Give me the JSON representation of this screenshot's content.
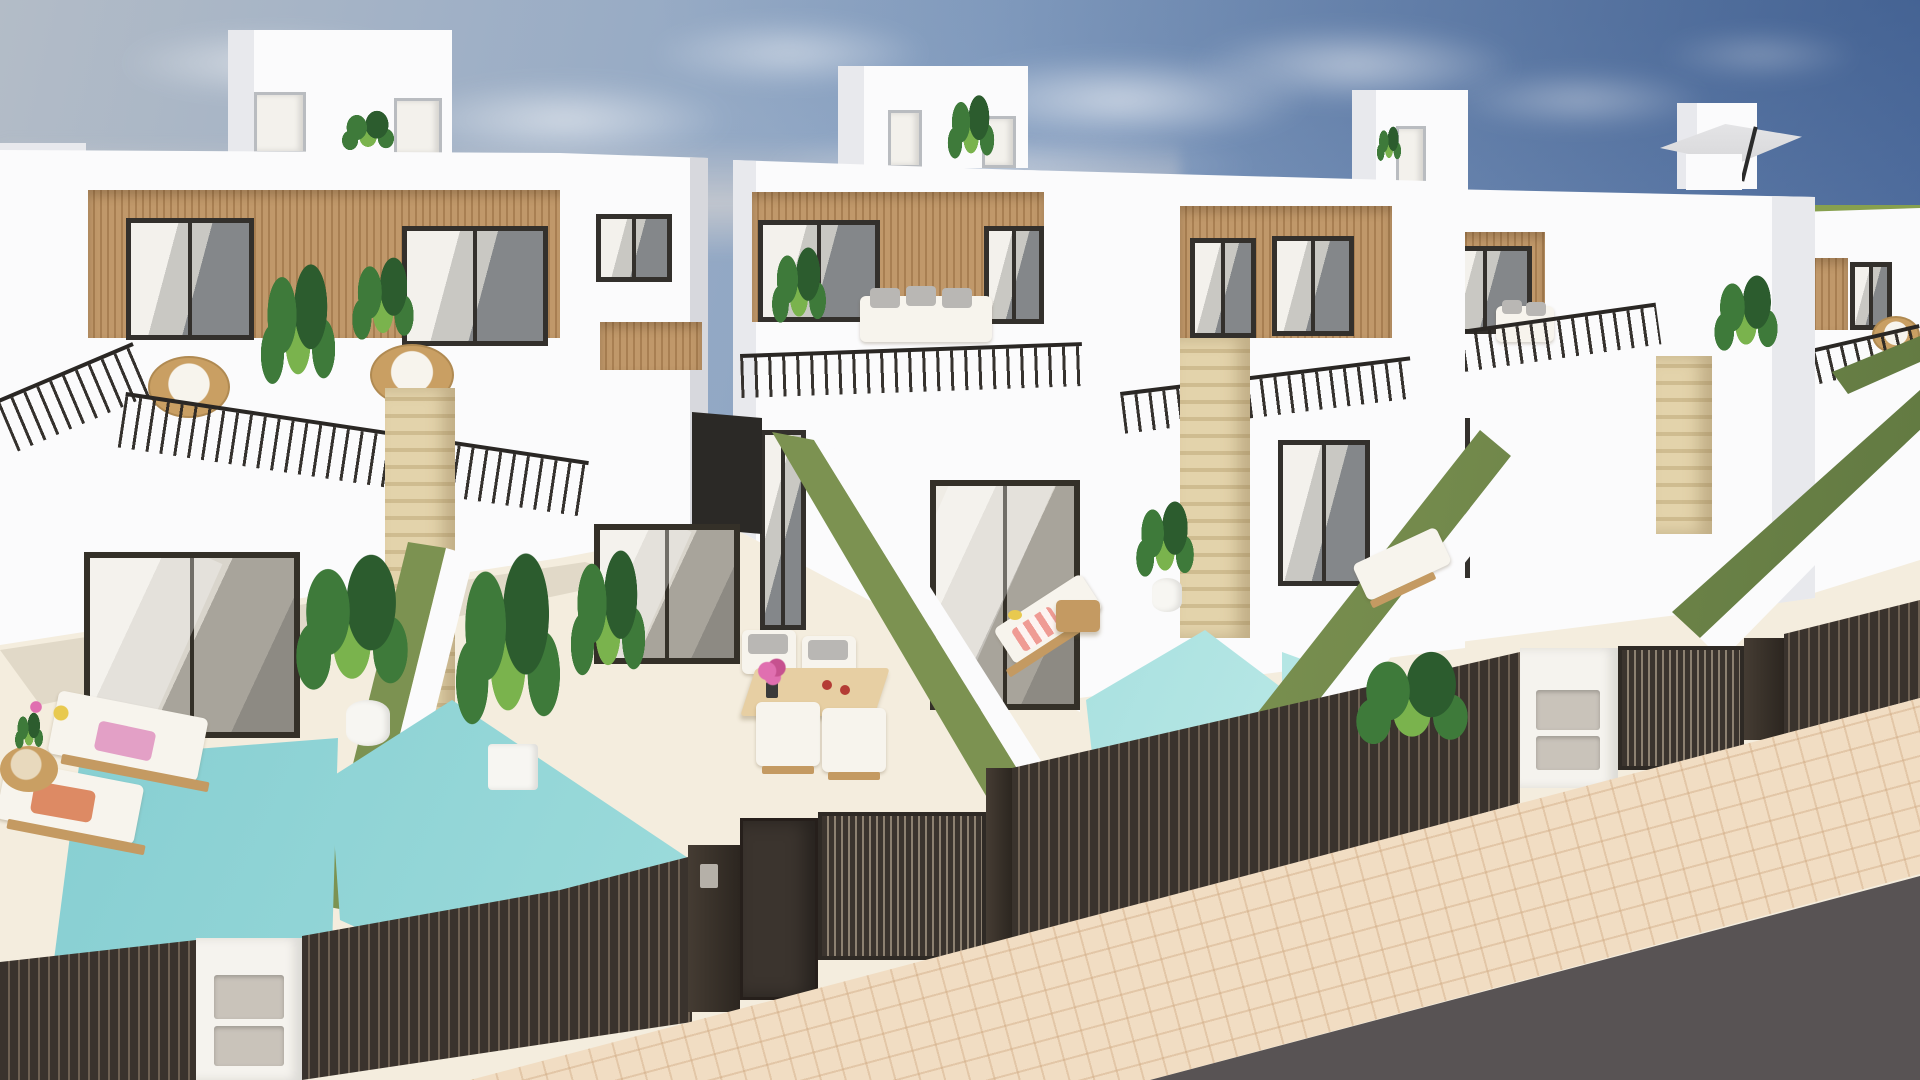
{
  "scene": {
    "type": "architectural-3d-render",
    "description": "Aerial front view of a row of modern two/three-storey white villas with wood-clad window recesses, black balcony railings, travertine pillars, private courtyards with small turquoise plunge pools, olive-green artificial hedge walls between plots, dark brown slatted fences and gates along a beige paved sidewalk with asphalt road at lower right, under a blue sky with scattered clouds and a green field on the right horizon.",
    "houses": 5,
    "pools": 4,
    "objects": [
      "penthouse-roof-boxes",
      "roof-terrace-plants",
      "cantilever-umbrella",
      "wood-slat-cladding",
      "black-metal-railings",
      "rattan-egg-chairs",
      "white-outdoor-sofa",
      "travertine-pillars",
      "glass-sliding-doors",
      "artificial-grass-hedge-walls",
      "plunge-pools",
      "sun-loungers",
      "beach-towels",
      "outdoor-dining-set",
      "potted-plants",
      "slatted-fences",
      "entrance-gates",
      "letterbox-pillars",
      "intercom-plate",
      "herringbone-sidewalk",
      "asphalt-road"
    ]
  },
  "palette": {
    "sky_left": "#b3bcc7",
    "sky_mid": "#8aa3c4",
    "sky_right": "#4e6c9e",
    "cloud": "#eceff1",
    "field": "#87a04e",
    "field_dark": "#72893f",
    "wall": "#fbfbfc",
    "wall_shade": "#e8e9ed",
    "wall_dark": "#d7d8dd",
    "wood": "#c0986a",
    "wood_dark": "#a87f52",
    "frame": "#33302c",
    "glass_mid": "#c9c8c3",
    "glass_dark": "#84878a",
    "curtain": "#f3f1ec",
    "trav": "#e3d3ab",
    "trav_dark": "#cfbc90",
    "hedge": "#7c9251",
    "hedge_dark": "#5f7740",
    "pool_hi": "#c9efec",
    "pool": "#9adada",
    "pool_shadow": "#7cc8cd",
    "floor": "#f4edde",
    "fence": "#3a332d",
    "fence_gap": "#6e6153",
    "gate": "#3b342e",
    "pillar": "#f5f3ee",
    "panel": "#c9c3ba",
    "walk": "#f1ddc3",
    "walk_line": "#dcc0a0",
    "road": "#585354",
    "lwood": "#c49a62",
    "cushion": "#f7f4ed",
    "pillow": "#b9b7b4",
    "towel_pink": "#e3a0c6",
    "towel_coral": "#dd8a64",
    "towel_stripe": "#ef9b94",
    "plant": "#3e7a3a",
    "plant_dark": "#2c5c2e",
    "plant_lite": "#7ab34d",
    "rattan": "#c99f63",
    "umbrella": "#d8d8da",
    "metal": "#b5b0a8",
    "red_cup": "#b43c35",
    "flower_pink": "#e06fb0",
    "flower_yellow": "#e8c94f"
  }
}
